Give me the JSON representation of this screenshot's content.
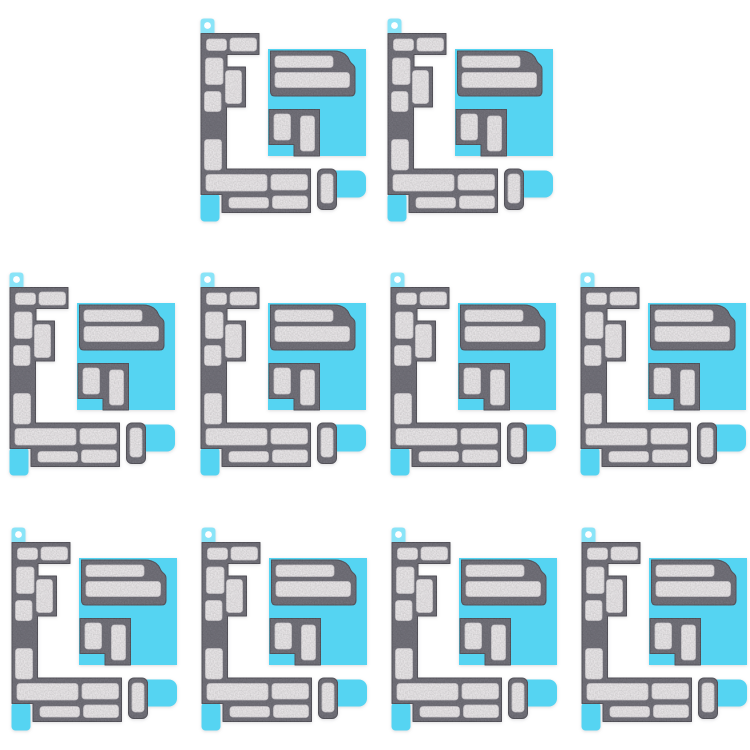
{
  "product": {
    "description": "Ten identical motherboard insulation adhesive sticker sheets on white background",
    "item_count": 10,
    "grid_rows": [
      2,
      4,
      4
    ],
    "colors": {
      "background": "#ffffff",
      "backing_cyan": "#55d4f2",
      "tab_cyan": "#8ae4f8",
      "foam_dark": "#787780",
      "foam_edge": "#5d5c64",
      "slot_white": "#f2eff1",
      "slot_edge": "#d9d5d9"
    },
    "units": [
      {
        "row": 1,
        "col": 1,
        "x": 196,
        "y": 16
      },
      {
        "row": 1,
        "col": 2,
        "x": 383,
        "y": 16
      },
      {
        "row": 2,
        "col": 1,
        "x": 5,
        "y": 270
      },
      {
        "row": 2,
        "col": 2,
        "x": 196,
        "y": 270
      },
      {
        "row": 2,
        "col": 3,
        "x": 386,
        "y": 270
      },
      {
        "row": 2,
        "col": 4,
        "x": 576,
        "y": 270
      },
      {
        "row": 3,
        "col": 1,
        "x": 7,
        "y": 525
      },
      {
        "row": 3,
        "col": 2,
        "x": 197,
        "y": 525
      },
      {
        "row": 3,
        "col": 3,
        "x": 387,
        "y": 525
      },
      {
        "row": 3,
        "col": 4,
        "x": 577,
        "y": 525
      }
    ]
  }
}
